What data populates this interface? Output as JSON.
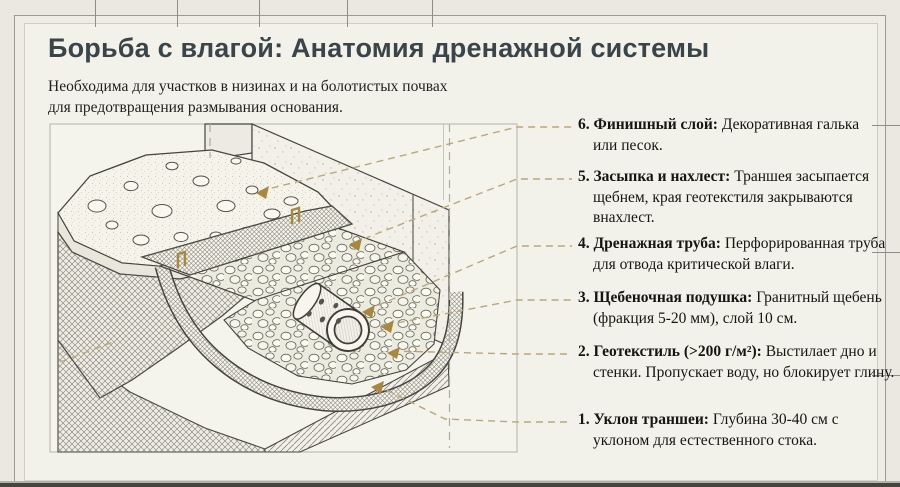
{
  "header": {
    "title": "Борьба с влагой: Анатомия дренажной системы",
    "subtitle_line1": "Необходима для участков в низинах и на болотистых почвах",
    "subtitle_line2": "для предотвращения размывания основания."
  },
  "legend": {
    "items": [
      {
        "number": "6",
        "lead": "6. Финишный слой:",
        "desc": "Декоративная галька или песок."
      },
      {
        "number": "5",
        "lead": "5. Засыпка и нахлест:",
        "desc": "Траншея засыпается щебнем, края геотекстиля закрываются внахлест."
      },
      {
        "number": "4",
        "lead": "4. Дренажная труба:",
        "desc": "Перфорированная труба для отвода критической влаги."
      },
      {
        "number": "3",
        "lead": "3. Щебеночная подушка:",
        "desc": "Гранитный щебень (фракция 5-20 мм), слой 10 см."
      },
      {
        "number": "2",
        "lead": "2. Геотекстиль (>200 г/м²):",
        "desc": "Выстилает дно и стенки. Пропускает воду, но блокирует глину."
      },
      {
        "number": "1",
        "lead": "1. Уклон траншеи:",
        "desc": "Глубина 30-40 см с уклоном для естественного стока."
      }
    ]
  },
  "diagram": {
    "style": "isometric cutaway technical drawing of drainage trench",
    "colors": {
      "leader_line": "#b9a87c",
      "arrow_marker": "#a8873f",
      "linework": "#45443e",
      "frame": "#b5b3aa"
    }
  }
}
